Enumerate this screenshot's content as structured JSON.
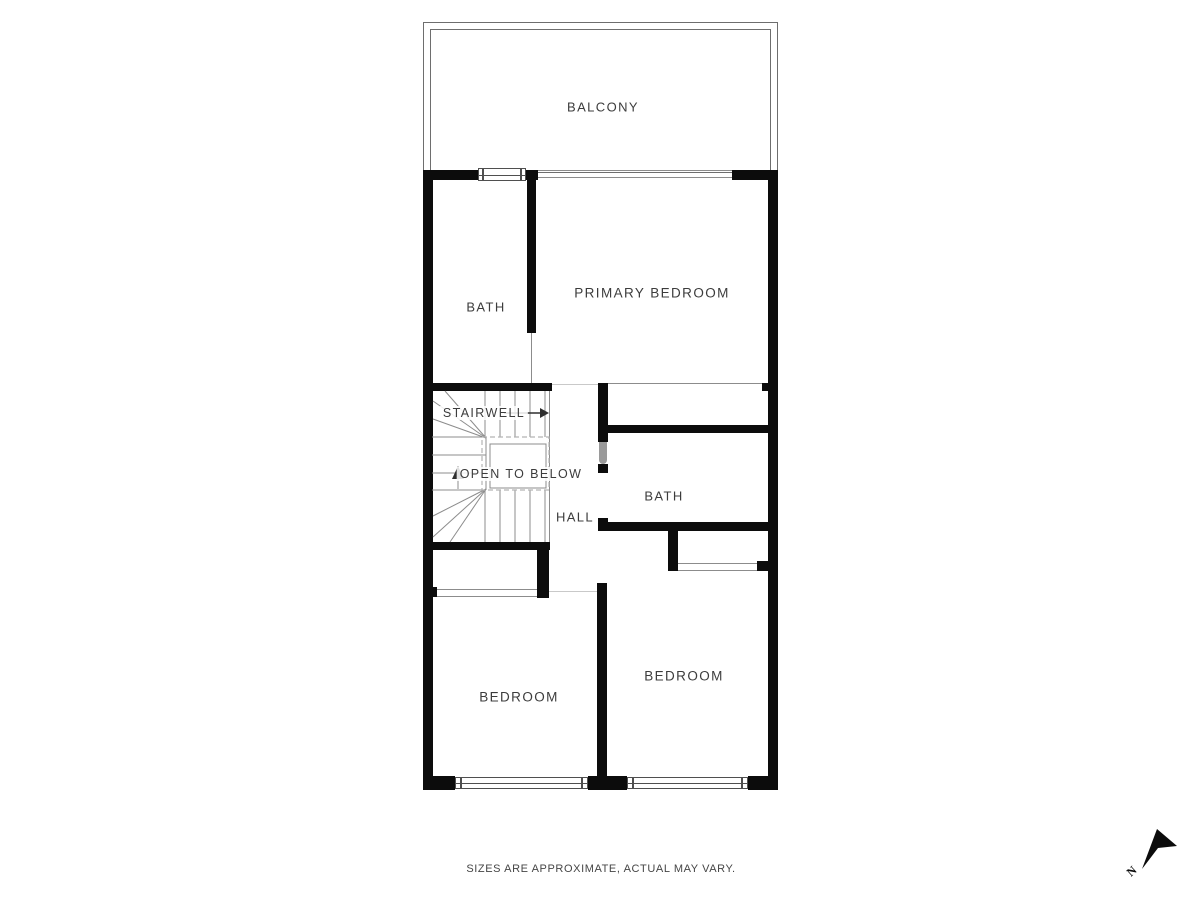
{
  "labels": {
    "balcony": "BALCONY",
    "bath_upper": "BATH",
    "primary_bedroom": "PRIMARY BEDROOM",
    "stairwell": "STAIRWELL",
    "open_to_below": "OPEN TO BELOW",
    "hall": "HALL",
    "bath_lower": "BATH",
    "bedroom_left": "BEDROOM",
    "bedroom_right": "BEDROOM"
  },
  "footer": {
    "disclaimer": "SIZES ARE APPROXIMATE, ACTUAL MAY VARY."
  },
  "compass": {
    "north_label": "N"
  },
  "colors": {
    "wall": "#0c0c0c",
    "stair_line": "#8c8c8c",
    "balcony_outline": "#6e6e6e",
    "text": "#3c3c3c",
    "background": "#ffffff"
  }
}
